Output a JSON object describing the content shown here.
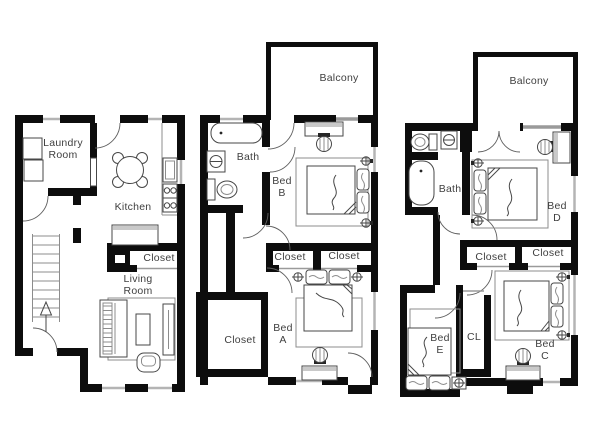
{
  "plan": {
    "type": "floor-plan",
    "colors": {
      "bg": "#ffffff",
      "wall": "#0d0d0d",
      "line": "#474747",
      "thin": "#8c8c8c",
      "window": "#b4b4b4",
      "panel": "#9a9a9a",
      "swing": "#5f5f5f",
      "shade": "#c9c9c9",
      "dark": "#262626",
      "text": "#3f3f3f"
    },
    "units": [
      {
        "id": "unit-1",
        "rooms": [
          {
            "id": "laundry-room",
            "label": "Laundry\nRoom"
          },
          {
            "id": "kitchen",
            "label": "Kitchen"
          },
          {
            "id": "closet",
            "label": "Closet"
          },
          {
            "id": "living-room",
            "label": "Living\nRoom"
          }
        ]
      },
      {
        "id": "unit-2",
        "rooms": [
          {
            "id": "balcony",
            "label": "Balcony"
          },
          {
            "id": "bath",
            "label": "Bath"
          },
          {
            "id": "bed-b",
            "label": "Bed\nB"
          },
          {
            "id": "closet-left",
            "label": "Closet"
          },
          {
            "id": "closet-right",
            "label": "Closet"
          },
          {
            "id": "closet-lower",
            "label": "Closet"
          },
          {
            "id": "bed-a",
            "label": "Bed\nA"
          }
        ]
      },
      {
        "id": "unit-3",
        "rooms": [
          {
            "id": "balcony",
            "label": "Balcony"
          },
          {
            "id": "bath",
            "label": "Bath"
          },
          {
            "id": "bed-d",
            "label": "Bed\nD"
          },
          {
            "id": "closet-left",
            "label": "Closet"
          },
          {
            "id": "closet-right",
            "label": "Closet"
          },
          {
            "id": "bed-e",
            "label": "Bed\nE"
          },
          {
            "id": "closet-cl",
            "label": "CL"
          },
          {
            "id": "bed-c",
            "label": "Bed\nC"
          }
        ]
      }
    ]
  }
}
